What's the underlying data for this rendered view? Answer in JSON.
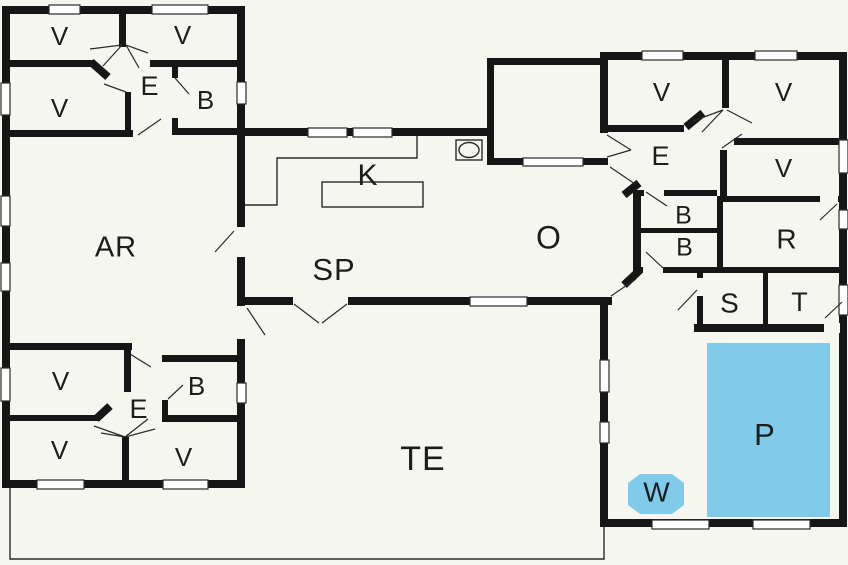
{
  "plan": {
    "type": "summerhouse-floor-plan",
    "rooms": [
      {
        "id": "bedroom-nw-1",
        "label": "V"
      },
      {
        "id": "bedroom-nw-2",
        "label": "V"
      },
      {
        "id": "hall-nw",
        "label": "E"
      },
      {
        "id": "bath-nw",
        "label": "B"
      },
      {
        "id": "bedroom-nw-3",
        "label": "V"
      },
      {
        "id": "activity-room",
        "label": "AR"
      },
      {
        "id": "kitchen",
        "label": "K"
      },
      {
        "id": "dining",
        "label": "SP"
      },
      {
        "id": "living-room",
        "label": "O"
      },
      {
        "id": "bedroom-sw-1",
        "label": "V"
      },
      {
        "id": "bath-sw",
        "label": "B"
      },
      {
        "id": "hall-sw",
        "label": "E"
      },
      {
        "id": "bedroom-sw-2",
        "label": "V"
      },
      {
        "id": "bedroom-sw-3",
        "label": "V"
      },
      {
        "id": "terrace",
        "label": "TE"
      },
      {
        "id": "bedroom-ne-1",
        "label": "V"
      },
      {
        "id": "bedroom-ne-2",
        "label": "V"
      },
      {
        "id": "hall-ne",
        "label": "E"
      },
      {
        "id": "bedroom-ne-3",
        "label": "V"
      },
      {
        "id": "bath-ne-1",
        "label": "B"
      },
      {
        "id": "bath-ne-2",
        "label": "B"
      },
      {
        "id": "utility-room",
        "label": "R"
      },
      {
        "id": "sauna",
        "label": "S"
      },
      {
        "id": "toilet",
        "label": "T"
      },
      {
        "id": "pool",
        "label": "P"
      },
      {
        "id": "whirlpool",
        "label": "W"
      }
    ]
  },
  "colors": {
    "wall": "#161616",
    "pool": "#7fcbe9",
    "background": "#f6f6f1",
    "label": "#1d1d1d"
  }
}
